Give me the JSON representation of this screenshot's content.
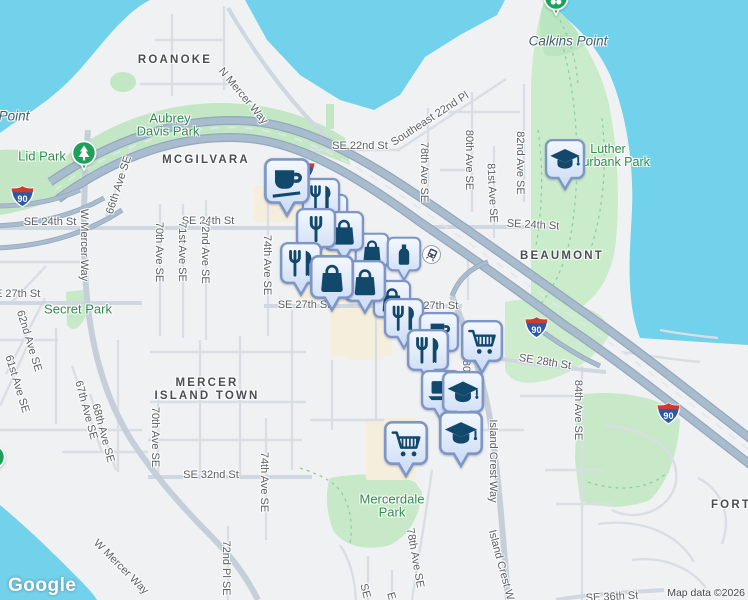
{
  "map": {
    "attribution": {
      "logo": "Google",
      "copyright": "Map data ©2026"
    },
    "shield_label": "90",
    "colors": {
      "land": "#f0f1f2",
      "water": "#72d2ec",
      "park": "#c7e9c8",
      "park_alt": "#cbecca",
      "commercial": "#f6eedd",
      "road_minor": "#d9dee5",
      "road_mid": "#cfd7e0",
      "road_major": "#c6cfd9",
      "highway": "#a9bccd",
      "highway_casing": "#93a8bd",
      "marker_border": "#7e96c6",
      "marker_icon": "#11486b",
      "label_street": "#5c6064",
      "label_neigh": "#4a4e52",
      "label_park": "#2e8b4f",
      "label_water": "#3f5f6b",
      "green_pin": "#1ba15a",
      "shield_blue": "#2b59a8",
      "shield_red": "#cf3a33"
    },
    "labels": [
      {
        "text": "ROANOKE",
        "x": 175,
        "y": 60,
        "cls": "neigh",
        "fs": 11.5
      },
      {
        "text": "MCGILVARA",
        "x": 206,
        "y": 160,
        "cls": "neigh",
        "fs": 11.5
      },
      {
        "text": "BEAUMONT",
        "x": 562,
        "y": 256,
        "cls": "neigh",
        "fs": 11.5
      },
      {
        "text": "MERCER",
        "x": 207,
        "y": 383,
        "cls": "neigh",
        "fs": 11.5
      },
      {
        "text": "ISLAND TOWN",
        "x": 207,
        "y": 396,
        "cls": "neigh",
        "fs": 11.5
      },
      {
        "text": "FORT",
        "x": 731,
        "y": 505,
        "cls": "neigh",
        "fs": 11.5
      },
      {
        "text": "Point",
        "x": 14,
        "y": 116,
        "cls": "water-lbl",
        "fs": 13.5
      },
      {
        "text": "Calkins Point",
        "x": 568,
        "y": 41,
        "cls": "water-lbl",
        "fs": 13.5
      },
      {
        "text": "Lid Park",
        "x": 42,
        "y": 156,
        "cls": "park",
        "fs": 13
      },
      {
        "text": "Aubrey",
        "x": 170,
        "y": 118,
        "cls": "park",
        "fs": 13
      },
      {
        "text": "Davis Park",
        "x": 168,
        "y": 131,
        "cls": "park",
        "fs": 13
      },
      {
        "text": "Secret Park",
        "x": 78,
        "y": 309,
        "cls": "park",
        "fs": 13
      },
      {
        "text": "Luther",
        "x": 608,
        "y": 149,
        "cls": "park",
        "fs": 12.5
      },
      {
        "text": "Burbank Park",
        "x": 612,
        "y": 162,
        "cls": "park",
        "fs": 12.5
      },
      {
        "text": "Mercerdale",
        "x": 392,
        "y": 499,
        "cls": "park",
        "fs": 13
      },
      {
        "text": "Park",
        "x": 392,
        "y": 512,
        "cls": "park",
        "fs": 13
      },
      {
        "text": "N Mercer Way",
        "x": 243,
        "y": 96,
        "rot": 50
      },
      {
        "text": "SE 22nd St",
        "x": 360,
        "y": 146
      },
      {
        "text": "Southeast 22nd Pl",
        "x": 430,
        "y": 119,
        "rot": -33
      },
      {
        "text": "78th Ave SE",
        "x": 424,
        "y": 172,
        "rot": 90
      },
      {
        "text": "80th Ave SE",
        "x": 469,
        "y": 160,
        "rot": 90
      },
      {
        "text": "81st Ave SE",
        "x": 492,
        "y": 193,
        "rot": 87
      },
      {
        "text": "82nd Ave SE",
        "x": 520,
        "y": 163,
        "rot": 90
      },
      {
        "text": "SE 24th St",
        "x": 50,
        "y": 222
      },
      {
        "text": "SE 24th St",
        "x": 208,
        "y": 221
      },
      {
        "text": "SE 24th St",
        "x": 533,
        "y": 225,
        "rot": 3
      },
      {
        "text": "W Mercer Way",
        "x": 84,
        "y": 245,
        "rot": 90
      },
      {
        "text": "66th Ave SE",
        "x": 119,
        "y": 185,
        "rot": -72
      },
      {
        "text": "70th Ave SE",
        "x": 159,
        "y": 252,
        "rot": 90
      },
      {
        "text": "71st Ave SE",
        "x": 182,
        "y": 252,
        "rot": 90
      },
      {
        "text": "72nd Ave SE",
        "x": 205,
        "y": 252,
        "rot": 90
      },
      {
        "text": "74th Ave SE",
        "x": 267,
        "y": 265,
        "rot": 90
      },
      {
        "text": "SE 27th St",
        "x": 14,
        "y": 294
      },
      {
        "text": "SE 27th St",
        "x": 304,
        "y": 305
      },
      {
        "text": "SE 27th St",
        "x": 432,
        "y": 306
      },
      {
        "text": "62nd Ave SE",
        "x": 29,
        "y": 341,
        "rot": 73
      },
      {
        "text": "61st Ave SE",
        "x": 17,
        "y": 384,
        "rot": 73
      },
      {
        "text": "80th Ave SE",
        "x": 466,
        "y": 390,
        "rot": 90
      },
      {
        "text": "SE 28th St",
        "x": 545,
        "y": 362,
        "rot": 9
      },
      {
        "text": "84th Ave SE",
        "x": 578,
        "y": 410,
        "rot": 90
      },
      {
        "text": "67th Ave SE",
        "x": 86,
        "y": 410,
        "rot": 75
      },
      {
        "text": "68th Ave SE",
        "x": 103,
        "y": 433,
        "rot": 75
      },
      {
        "text": "70th Ave SE",
        "x": 155,
        "y": 437,
        "rot": 90
      },
      {
        "text": "SE 32nd St",
        "x": 211,
        "y": 475
      },
      {
        "text": "74th Ave SE",
        "x": 264,
        "y": 482,
        "rot": 90
      },
      {
        "text": "Island Crest Way",
        "x": 493,
        "y": 461,
        "rot": 90
      },
      {
        "text": "Island Crest W",
        "x": 501,
        "y": 565,
        "rot": 75
      },
      {
        "text": "78th Ave SE",
        "x": 415,
        "y": 558,
        "rot": 80
      },
      {
        "text": "72nd Pl SE",
        "x": 226,
        "y": 568,
        "rot": 90
      },
      {
        "text": "W Mercer Way",
        "x": 121,
        "y": 567,
        "rot": 45
      },
      {
        "text": "SE",
        "x": 365,
        "y": 591,
        "rot": 75
      },
      {
        "text": "E",
        "x": 391,
        "y": 596,
        "rot": 75
      },
      {
        "text": "SE 36th St",
        "x": 612,
        "y": 597,
        "rot": -3
      }
    ],
    "markers": [
      {
        "icon": "bag",
        "x": 372,
        "y": 250,
        "s": 36
      },
      {
        "icon": "bottle",
        "x": 404,
        "y": 254,
        "s": 36
      },
      {
        "icon": "restaurant",
        "x": 330,
        "y": 212,
        "s": 38
      },
      {
        "icon": "restaurant",
        "x": 321,
        "y": 197,
        "s": 40
      },
      {
        "icon": "bag",
        "x": 344,
        "y": 231,
        "s": 42
      },
      {
        "icon": "fork",
        "x": 316,
        "y": 228,
        "s": 42
      },
      {
        "icon": "coffee",
        "x": 287,
        "y": 181,
        "s": 48
      },
      {
        "icon": "bag",
        "x": 392,
        "y": 299,
        "s": 40
      },
      {
        "icon": "restaurant",
        "x": 404,
        "y": 318,
        "s": 42
      },
      {
        "icon": "bag",
        "x": 365,
        "y": 281,
        "s": 44
      },
      {
        "icon": "restaurant",
        "x": 301,
        "y": 263,
        "s": 44
      },
      {
        "icon": "bag",
        "x": 332,
        "y": 277,
        "s": 46
      },
      {
        "icon": "cup-saucer",
        "x": 439,
        "y": 332,
        "s": 42
      },
      {
        "icon": "restaurant",
        "x": 428,
        "y": 350,
        "s": 44
      },
      {
        "icon": "cart",
        "x": 482,
        "y": 341,
        "s": 44
      },
      {
        "icon": "laptop",
        "x": 441,
        "y": 390,
        "s": 42
      },
      {
        "icon": "gradcap",
        "x": 463,
        "y": 392,
        "s": 44
      },
      {
        "icon": "gradcap",
        "x": 461,
        "y": 433,
        "s": 46
      },
      {
        "icon": "cart",
        "x": 406,
        "y": 443,
        "s": 46
      },
      {
        "icon": "gradcap",
        "x": 565,
        "y": 159,
        "s": 42
      }
    ],
    "green_pins": [
      {
        "icon": "tree",
        "x": 84,
        "y": 153
      },
      {
        "icon": "flower",
        "x": 556,
        "y": -2
      },
      {
        "icon": "tree",
        "x": -7,
        "y": 457
      }
    ],
    "shields": [
      {
        "x": 22,
        "y": 196
      },
      {
        "x": 303,
        "y": 171
      },
      {
        "x": 536,
        "y": 327
      },
      {
        "x": 668,
        "y": 413
      }
    ],
    "transit": {
      "x": 431,
      "y": 254
    }
  }
}
